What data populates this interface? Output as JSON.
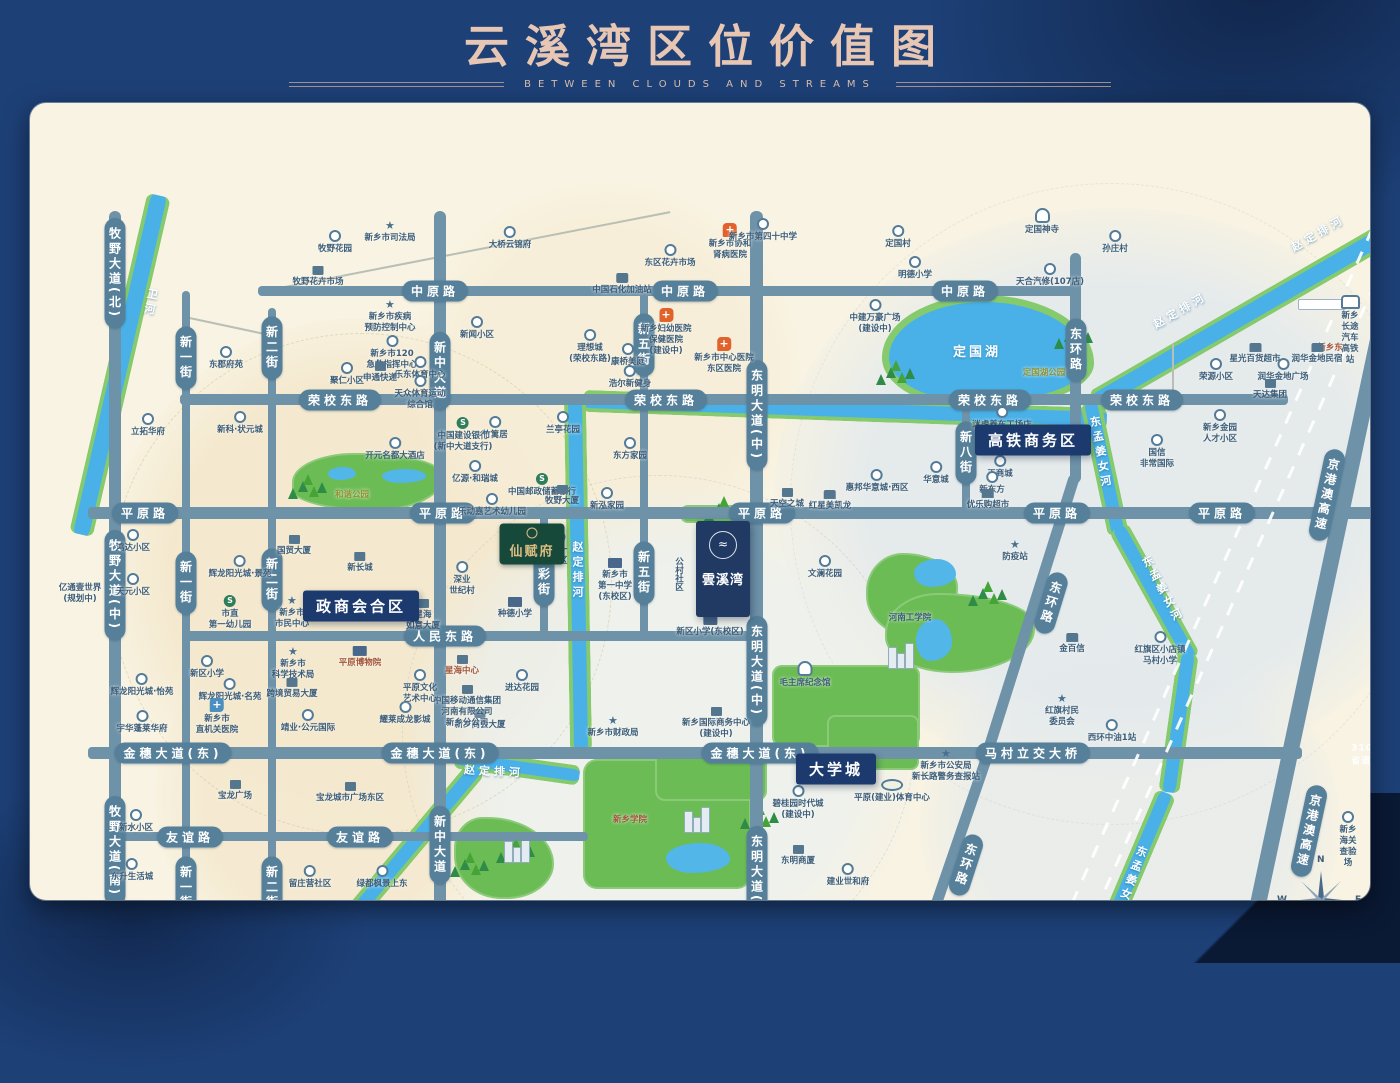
{
  "title": {
    "main": "云溪湾区位价值图",
    "subtitle": "BETWEEN CLOUDS AND STREAMS"
  },
  "compass": {
    "n": "N",
    "e": "E",
    "s": "S",
    "w": "W"
  },
  "colors": {
    "frame": "#1d4077",
    "map_bg": "#f8f3e2",
    "road": "#6e92a8",
    "road_capsule": "#56809a",
    "river": "#49b1e7",
    "river_bank": "#85ca6d",
    "park": "#6cbc55",
    "badge": "#1c3a6d",
    "title_text": "#e7c6b4",
    "hospital_pin": "#e2622b",
    "poi_text": "#3c5d78"
  },
  "project": {
    "x": 693,
    "y": 466,
    "name": "雲溪湾",
    "adjacent_park": "街南公园(在建)"
  },
  "estate_badge": {
    "x": 502,
    "y": 441,
    "label": "仙赋府"
  },
  "badges": [
    [
      "高铁商务区",
      1003,
      337
    ],
    [
      "政商会合区",
      331,
      503
    ],
    [
      "大学城",
      806,
      666
    ]
  ],
  "zones": [
    [
      330,
      470,
      510,
      510,
      "rgba(244,232,205,0.95)"
    ],
    [
      575,
      275,
      390,
      390,
      "rgba(246,237,214,0.85)"
    ],
    [
      300,
      695,
      350,
      350,
      "rgba(244,232,205,0.8)"
    ],
    [
      1085,
      390,
      680,
      570,
      "rgba(226,233,237,0.85)"
    ],
    [
      635,
      635,
      510,
      510,
      "rgba(234,240,240,0.7)"
    ],
    [
      1100,
      720,
      420,
      380,
      "rgba(228,234,237,0.7)"
    ]
  ],
  "rings": [
    [
      330,
      480,
      500,
      "rgba(205,185,140,0.55)"
    ],
    [
      628,
      628,
      512,
      "rgba(175,195,205,0.5)"
    ],
    [
      1080,
      400,
      640,
      "rgba(185,200,210,0.4)"
    ]
  ],
  "roads_h": [
    [
      228,
      183,
      822,
      10
    ],
    [
      150,
      291,
      1108,
      11
    ],
    [
      58,
      404,
      1287,
      12
    ],
    [
      153,
      528,
      574,
      10
    ],
    [
      58,
      644,
      1214,
      12
    ],
    [
      83,
      729,
      475,
      9
    ],
    [
      58,
      862,
      720,
      11
    ]
  ],
  "roads_v": [
    [
      79,
      108,
      12,
      790
    ],
    [
      152,
      188,
      8,
      710
    ],
    [
      238,
      205,
      8,
      693
    ],
    [
      404,
      108,
      12,
      790
    ],
    [
      510,
      408,
      8,
      127
    ],
    [
      610,
      186,
      8,
      350
    ],
    [
      720,
      108,
      13,
      790
    ],
    [
      932,
      297,
      8,
      115
    ],
    [
      1040,
      150,
      11,
      230
    ]
  ],
  "roads_diag": [
    [
      1001,
      510,
      11,
      290,
      17.5
    ],
    [
      928,
      736,
      11,
      187,
      19
    ],
    [
      1288,
      519,
      16,
      796,
      12
    ]
  ],
  "roads_thin": [
    [
      435,
      148,
      418,
      -11
    ],
    [
      1036,
      852,
      290,
      -3
    ],
    [
      197,
      222,
      90,
      12
    ],
    [
      889,
      861,
      78,
      75
    ],
    [
      1143,
      270,
      60,
      90
    ]
  ],
  "road_labels": [
    [
      "中原路",
      405,
      188,
      "h",
      0
    ],
    [
      "中原路",
      655,
      188,
      "h",
      0
    ],
    [
      "中原路",
      935,
      188,
      "h",
      0
    ],
    [
      "荣校东路",
      310,
      297,
      "h",
      0
    ],
    [
      "荣校东路",
      636,
      297,
      "h",
      0
    ],
    [
      "荣校东路",
      960,
      297,
      "h",
      0
    ],
    [
      "荣校东路",
      1112,
      297,
      "h",
      0
    ],
    [
      "平原路",
      115,
      410,
      "h",
      0
    ],
    [
      "平原路",
      413,
      410,
      "h",
      0
    ],
    [
      "平原路",
      732,
      410,
      "h",
      0
    ],
    [
      "平原路",
      1027,
      410,
      "h",
      0
    ],
    [
      "平原路",
      1192,
      410,
      "h",
      0
    ],
    [
      "人民东路",
      415,
      533,
      "h",
      0
    ],
    [
      "金穗大道(东)",
      143,
      650,
      "h",
      0
    ],
    [
      "金穗大道(东)",
      410,
      650,
      "h",
      0
    ],
    [
      "金穗大道(东)",
      730,
      650,
      "h",
      0
    ],
    [
      "马村立交大桥",
      1003,
      650,
      "h",
      0
    ],
    [
      "友谊路",
      160,
      734,
      "h",
      0
    ],
    [
      "友谊路",
      330,
      734,
      "h",
      0
    ],
    [
      "向阳路",
      160,
      868,
      "h",
      0
    ],
    [
      "向阳路",
      415,
      868,
      "h",
      0
    ],
    [
      "向阳路",
      727,
      868,
      "h",
      0
    ],
    [
      "牧野大道(北)",
      85,
      170,
      "v",
      0
    ],
    [
      "牧野大道(中)",
      85,
      482,
      "v",
      0
    ],
    [
      "牧野大道(南)",
      85,
      748,
      "v",
      0
    ],
    [
      "新一街",
      156,
      255,
      "v",
      0
    ],
    [
      "新一街",
      156,
      480,
      "v",
      0
    ],
    [
      "新一街",
      156,
      785,
      "v",
      0
    ],
    [
      "新二街",
      242,
      245,
      "v",
      0
    ],
    [
      "新二街",
      242,
      477,
      "v",
      0
    ],
    [
      "新二街",
      242,
      785,
      "v",
      0
    ],
    [
      "新中大道",
      410,
      268,
      "v",
      0
    ],
    [
      "新中大道",
      410,
      742,
      "v",
      0
    ],
    [
      "福彩街",
      514,
      472,
      "v",
      0
    ],
    [
      "新五街",
      614,
      242,
      "v",
      0
    ],
    [
      "新五街",
      614,
      470,
      "v",
      0
    ],
    [
      "东明大道(中)",
      727,
      312,
      "v",
      0
    ],
    [
      "东明大道(中)",
      727,
      568,
      "v",
      0
    ],
    [
      "东明大道(南)",
      727,
      778,
      "v",
      0
    ],
    [
      "新八街",
      936,
      350,
      "v",
      0
    ],
    [
      "东环路",
      1046,
      247,
      "v",
      0
    ],
    [
      "东环路",
      1021,
      500,
      "v",
      17
    ],
    [
      "东环路",
      936,
      762,
      "v",
      18
    ],
    [
      "京港澳高速",
      1297,
      392,
      "v",
      12
    ],
    [
      "京港澳高速",
      1279,
      728,
      "v",
      12
    ],
    [
      "310省道",
      1332,
      652,
      "p",
      0
    ]
  ],
  "rivers": [
    [
      90,
      262,
      16,
      348,
      13,
      "v"
    ],
    [
      1233,
      202,
      16,
      390,
      -30,
      "h"
    ],
    [
      815,
      307,
      14,
      524,
      2,
      "h"
    ],
    [
      548,
      472,
      14,
      352,
      -1,
      "v"
    ],
    [
      487,
      664,
      12,
      126,
      8,
      "h"
    ],
    [
      350,
      780,
      13,
      300,
      40,
      "v"
    ],
    [
      1074,
      365,
      13,
      135,
      -12,
      "v"
    ],
    [
      1124,
      490,
      13,
      150,
      -29,
      "v"
    ],
    [
      1148,
      620,
      13,
      140,
      8,
      "v"
    ],
    [
      1092,
      793,
      13,
      225,
      23,
      "v"
    ]
  ],
  "river_labels": [
    [
      "卫河",
      120,
      200,
      "v",
      10
    ],
    [
      "赵定排河",
      1288,
      130,
      "h",
      -30
    ],
    [
      "赵定排河",
      1150,
      207,
      "h",
      -30
    ],
    [
      "赵定排河",
      547,
      468,
      "v",
      0
    ],
    [
      "赵定排河",
      464,
      668,
      "h",
      3
    ],
    [
      "赵定排河",
      300,
      836,
      "h",
      -50
    ],
    [
      "东孟姜女河",
      1070,
      350,
      "v",
      -10
    ],
    [
      "东孟姜女河",
      1132,
      487,
      "v",
      -28
    ],
    [
      "东孟姜女河",
      1100,
      778,
      "v",
      20
    ]
  ],
  "lake": {
    "x": 852,
    "y": 192,
    "w": 198,
    "h": 100,
    "label": "定国湖"
  },
  "parks": [
    [
      262,
      350,
      152,
      58,
      "45% 55% 50% 60% / 55% 45% 65% 40%"
    ],
    [
      650,
      402,
      76,
      18,
      "8px"
    ],
    [
      700,
      416,
      16,
      98,
      "6px"
    ],
    [
      836,
      450,
      92,
      85,
      "40% 60% 45% 55% / 45% 40% 60% 50%"
    ],
    [
      855,
      490,
      150,
      80,
      "35% 65% 55% 45% / 50% 40% 55% 45%"
    ],
    [
      742,
      562,
      148,
      82,
      "10px"
    ],
    [
      797,
      612,
      92,
      55,
      "8px"
    ],
    [
      553,
      656,
      168,
      130,
      "14px"
    ],
    [
      625,
      646,
      112,
      52,
      "10px"
    ],
    [
      424,
      714,
      100,
      82,
      "30% 70% 50% 50% / 40% 60% 45% 55%"
    ],
    [
      330,
      812,
      48,
      40,
      "40% 60% 50% 50%"
    ]
  ],
  "ponds": [
    [
      298,
      364,
      28,
      13
    ],
    [
      352,
      366,
      44,
      14
    ],
    [
      884,
      456,
      42,
      28
    ],
    [
      886,
      516,
      36,
      42
    ],
    [
      636,
      740,
      64,
      30
    ]
  ],
  "trees": [
    [
      268,
      378
    ],
    [
      856,
      264
    ],
    [
      1034,
      228
    ],
    [
      684,
      400
    ],
    [
      430,
      756
    ],
    [
      340,
      826
    ],
    [
      720,
      708
    ],
    [
      948,
      485
    ],
    [
      476,
      742
    ]
  ],
  "buildings": [
    [
      858,
      540
    ],
    [
      654,
      704
    ],
    [
      474,
      734
    ]
  ],
  "railway": [
    [
      1173,
      505,
      880,
      24
    ],
    [
      1196,
      514,
      880,
      24
    ]
  ],
  "station_platform": {
    "x": 1268,
    "y": 196
  },
  "pois": [
    [
      305,
      127,
      "dot",
      "牧野花园"
    ],
    [
      360,
      117,
      "star",
      "新乡市司法局"
    ],
    [
      288,
      163,
      "bld",
      "牧野花卉市场"
    ],
    [
      480,
      123,
      "dot",
      "大桥云锦府"
    ],
    [
      196,
      243,
      "dot",
      "东郡府苑"
    ],
    [
      360,
      196,
      "star",
      "新乡市疾病\n预防控制中心"
    ],
    [
      362,
      232,
      "dot",
      "新乡市120\n急救指挥中心"
    ],
    [
      390,
      253,
      "dot",
      "乐东体育中心"
    ],
    [
      317,
      259,
      "dot",
      "聚仁小区"
    ],
    [
      350,
      259,
      "bld",
      "申通快递"
    ],
    [
      390,
      272,
      "dot",
      "天众体育运动\n综合馆"
    ],
    [
      447,
      213,
      "dot",
      "新闻小区"
    ],
    [
      118,
      310,
      "dot",
      "立拓华府"
    ],
    [
      210,
      308,
      "dot",
      "新科·状元城"
    ],
    [
      433,
      314,
      "bank",
      "中国建设银行\n(新中大道支行)"
    ],
    [
      465,
      313,
      "dot",
      "竹篱居"
    ],
    [
      533,
      308,
      "dot",
      "兰亭花园"
    ],
    [
      600,
      334,
      "dot",
      "东方家园"
    ],
    [
      512,
      370,
      "bank",
      "中国邮政储蓄银行"
    ],
    [
      532,
      382,
      "bld",
      "牧野大厦"
    ],
    [
      462,
      390,
      "dot",
      "乐动嘉艺术幼儿园"
    ],
    [
      365,
      334,
      "dot",
      "开元名都大酒店"
    ],
    [
      445,
      357,
      "dot",
      "亿源·和瑞城"
    ],
    [
      560,
      226,
      "dot",
      "理想城\n(荣校东路)"
    ],
    [
      598,
      240,
      "dot",
      "康桥美庭"
    ],
    [
      600,
      262,
      "dot",
      "浩尔新健身"
    ],
    [
      636,
      205,
      "hosp",
      "新乡妇幼医院\n保健医院\n(建设中)"
    ],
    [
      694,
      234,
      "hosp",
      "新乡市中心医院\n东区医院"
    ],
    [
      640,
      141,
      "dot",
      "东区花卉市场"
    ],
    [
      700,
      120,
      "hosp",
      "新乡市协和\n肾病医院"
    ],
    [
      733,
      115,
      "dot",
      "新乡市第四十中学"
    ],
    [
      592,
      170,
      "gas",
      "中国石化加油站"
    ],
    [
      868,
      122,
      "dot",
      "定国村"
    ],
    [
      885,
      153,
      "dot",
      "明德小学"
    ],
    [
      1020,
      160,
      "dot",
      "天合汽修(107店)"
    ],
    [
      1012,
      105,
      "temple",
      "定国神寺"
    ],
    [
      1085,
      127,
      "dot",
      "孙庄村"
    ],
    [
      1320,
      192,
      "train",
      "新乡长途汽车\n高铁站"
    ],
    [
      1300,
      238,
      "none",
      "新乡东",
      "brown"
    ],
    [
      845,
      196,
      "dot",
      "中建万豪广场\n(建设中)"
    ],
    [
      1225,
      240,
      "shop",
      "星光百货超市"
    ],
    [
      1287,
      240,
      "shop",
      "润华金地民宿"
    ],
    [
      1186,
      255,
      "dot",
      "荣源小区"
    ],
    [
      1253,
      255,
      "dot",
      "润华金地广场"
    ],
    [
      1240,
      276,
      "bld",
      "天达集团"
    ],
    [
      1190,
      306,
      "dot",
      "新乡金园\n人才小区"
    ],
    [
      1127,
      331,
      "dot",
      "国信\n非常国际"
    ],
    [
      972,
      303,
      "dot",
      "迷虎养车工场店"
    ],
    [
      970,
      352,
      "dot",
      "正商城"
    ],
    [
      962,
      368,
      "dot",
      "新东方"
    ],
    [
      958,
      386,
      "shop",
      "优乐购超市"
    ],
    [
      906,
      358,
      "dot",
      "华意城"
    ],
    [
      847,
      366,
      "dot",
      "惠邦华意城·西区"
    ],
    [
      800,
      387,
      "shop",
      "红星美凯龙"
    ],
    [
      757,
      385,
      "bld",
      "天空之城"
    ],
    [
      577,
      384,
      "dot",
      "新泓家园"
    ],
    [
      985,
      436,
      "star",
      "防疫站"
    ],
    [
      795,
      452,
      "dot",
      "文澜花园"
    ],
    [
      880,
      508,
      "none",
      "河南工学院"
    ],
    [
      775,
      558,
      "temple",
      "毛主席纪念馆"
    ],
    [
      686,
      604,
      "bld",
      "新乡国际商务中心\n(建设中)"
    ],
    [
      583,
      612,
      "star",
      "新乡市财政局"
    ],
    [
      450,
      606,
      "bld",
      "新乡商会大厦"
    ],
    [
      492,
      566,
      "dot",
      "进达花园"
    ],
    [
      432,
      552,
      "bld",
      "星海中心",
      "brown"
    ],
    [
      437,
      582,
      "bld",
      "中国移动通信集团\n河南有限公司\n新乡分公司"
    ],
    [
      375,
      598,
      "dot",
      "耀莱成龙影城"
    ],
    [
      390,
      566,
      "dot",
      "平原文化\n艺术中心"
    ],
    [
      330,
      543,
      "school",
      "平原博物院",
      "brown"
    ],
    [
      263,
      543,
      "star",
      "新乡市\n科学技术局"
    ],
    [
      262,
      575,
      "bld",
      "跨境贸易大厦"
    ],
    [
      278,
      606,
      "dot",
      "靖业·公元国际"
    ],
    [
      200,
      492,
      "bank",
      "市直\n第一幼儿园"
    ],
    [
      210,
      452,
      "dot",
      "辉龙阳光城·景苑"
    ],
    [
      264,
      432,
      "bld",
      "国贸大厦"
    ],
    [
      262,
      492,
      "star",
      "新乡市\n市民中心"
    ],
    [
      330,
      449,
      "bld",
      "新长城"
    ],
    [
      393,
      496,
      "bld",
      "星海\n如意大厦"
    ],
    [
      432,
      458,
      "dot",
      "深业\n世纪村"
    ],
    [
      529,
      428,
      "dot",
      "八一\n小区"
    ],
    [
      485,
      494,
      "school",
      "种德小学"
    ],
    [
      585,
      455,
      "school",
      "新乡市\n第一中学\n(东校区)"
    ],
    [
      680,
      512,
      "school",
      "新区小学(东校区)"
    ],
    [
      648,
      452,
      "none",
      "公村社区",
      "",
      1
    ],
    [
      103,
      426,
      "dot",
      "鸿达小区"
    ],
    [
      103,
      470,
      "dot",
      "天元小区"
    ],
    [
      50,
      478,
      "none",
      "亿通壹世界\n(规划中)"
    ],
    [
      112,
      570,
      "dot",
      "辉龙阳光城·怡苑"
    ],
    [
      112,
      607,
      "dot",
      "宇华蓬莱华府"
    ],
    [
      177,
      552,
      "dot",
      "新区小学"
    ],
    [
      200,
      575,
      "dot",
      "辉龙阳光城·名苑"
    ],
    [
      187,
      595,
      "pinb",
      "新乡市\n直机关医院"
    ],
    [
      205,
      677,
      "bld",
      "宝龙广场"
    ],
    [
      320,
      679,
      "bld",
      "宝龙城市广场东区"
    ],
    [
      106,
      706,
      "dot",
      "新水小区"
    ],
    [
      102,
      755,
      "dot",
      "东升生活城"
    ],
    [
      92,
      808,
      "dot",
      "达安花园"
    ],
    [
      137,
      808,
      "dot",
      "建业壹号城邦"
    ],
    [
      280,
      762,
      "dot",
      "留庄营社区"
    ],
    [
      352,
      762,
      "dot",
      "绿都枫景上东"
    ],
    [
      600,
      710,
      "none",
      "新乡学院",
      "brown"
    ],
    [
      345,
      848,
      "none",
      "赵定河游园",
      "brown"
    ],
    [
      768,
      682,
      "dot",
      "碧桂园时代城\n(建设中)"
    ],
    [
      768,
      742,
      "bld",
      "东明商厦"
    ],
    [
      818,
      760,
      "dot",
      "建业世和府"
    ],
    [
      903,
      808,
      "bld",
      "菜鸟驿站"
    ],
    [
      878,
      832,
      "dot",
      "建业世和府\n营销中心"
    ],
    [
      824,
      838,
      "dot",
      "有幸桑拿鸡"
    ],
    [
      957,
      826,
      "dot",
      "新乡市\n新龙驾校"
    ],
    [
      1035,
      821,
      "dot",
      "尚典卫浴"
    ],
    [
      916,
      645,
      "star",
      "新乡市公安局\n新长路警务查报站"
    ],
    [
      862,
      676,
      "stad",
      "平原(建业)体育中心"
    ],
    [
      1032,
      590,
      "star",
      "红旗村民\n委员会"
    ],
    [
      1130,
      528,
      "dot",
      "红旗区小店镇\n马村小学"
    ],
    [
      1042,
      530,
      "shop",
      "金百信"
    ],
    [
      1082,
      616,
      "dot",
      "西环中油1站"
    ],
    [
      1318,
      708,
      "dot",
      "新乡海关查验场"
    ],
    [
      947,
      240,
      "none",
      "定国湖",
      "white"
    ],
    [
      1014,
      263,
      "none",
      "定国湖公园",
      "olive"
    ],
    [
      322,
      385,
      "none",
      "和谐公园",
      "olive"
    ]
  ]
}
